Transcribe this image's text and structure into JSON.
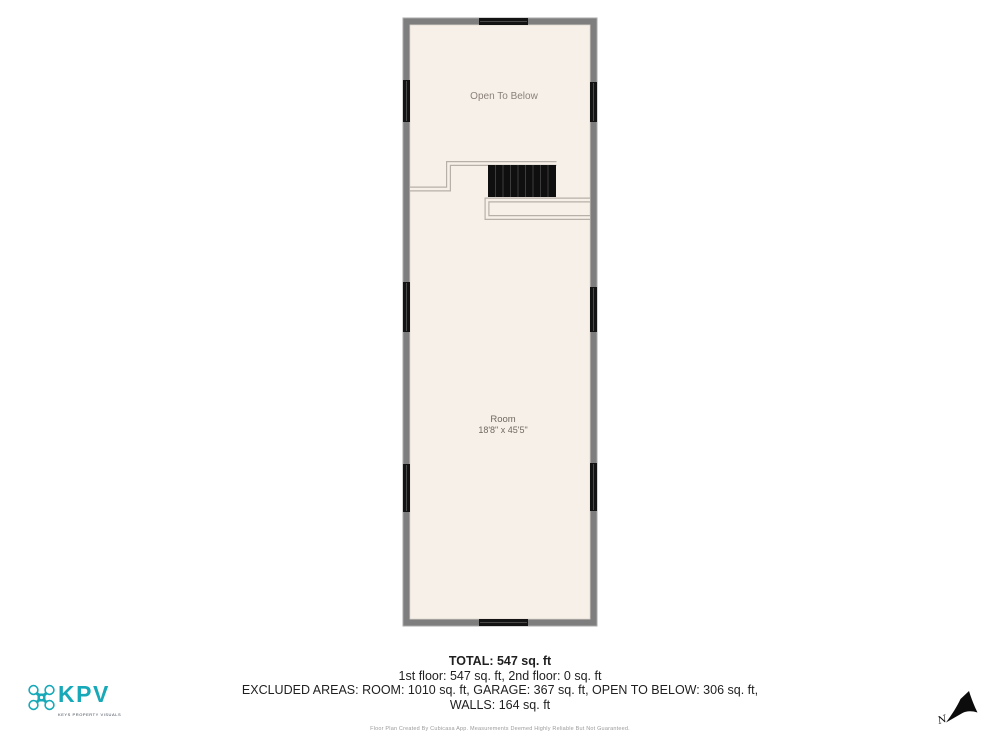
{
  "floorplan": {
    "open_to_below_label": "Open To Below",
    "room_label": "Room",
    "room_dimensions": "18'8\" x 45'5\""
  },
  "summary": {
    "total": "TOTAL: 547 sq. ft",
    "floors_line": "1st floor: 547 sq. ft, 2nd floor: 0 sq. ft",
    "excluded_line": "EXCLUDED AREAS: ROOM: 1010 sq. ft, GARAGE: 367 sq. ft, OPEN TO BELOW: 306 sq. ft,",
    "walls_line": "WALLS: 164 sq. ft"
  },
  "footer": {
    "disclaimer": "Floor Plan Created By Cubicasa App. Measurements Deemed Highly Reliable But Not Guaranteed."
  },
  "branding": {
    "logo_text": "KPV",
    "tagline": "KEYS PROPERTY VISUALS"
  },
  "compass": {
    "north_label": "N"
  },
  "colors": {
    "wall_gray": "#7e7e7e",
    "floor_cream": "#f7f0e9",
    "window_black": "#131313",
    "railing_line": "#b6b0a8",
    "accent_teal": "#17a9b8"
  }
}
